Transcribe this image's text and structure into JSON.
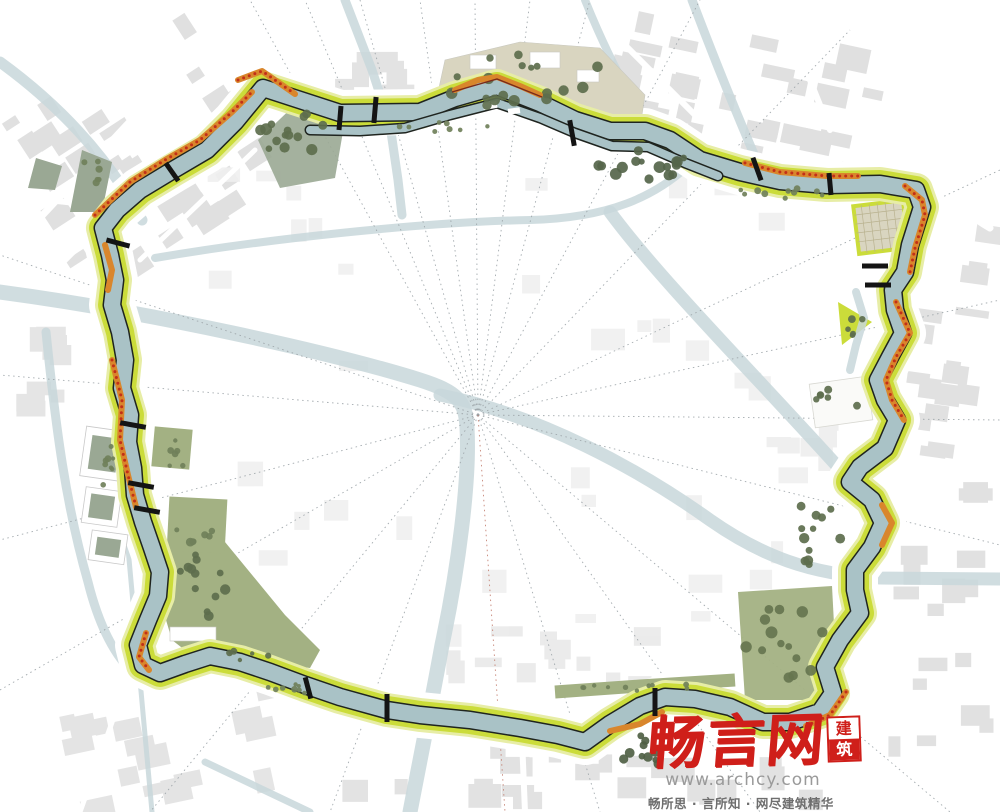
{
  "watermark": {
    "logo_text": "畅言网",
    "seal_top": "建",
    "seal_bottom": "筑",
    "url": "www.archcy.com",
    "slogan": "畅所思 · 言所知 · 网尽建筑精华"
  },
  "palette": {
    "water_ring": "#a9c2c6",
    "water_pale": "#c8d7da",
    "bank_green": "#cbdc3a",
    "bank_light": "#e7eda6",
    "quay_black": "#1f241f",
    "tree_dark": "#5d6e4d",
    "tree_mid": "#70805a",
    "park_olive": "#a3b183",
    "park_sage": "#9aa894",
    "park_beige": "#d9d5c0",
    "block_gray": "#e0e0e0",
    "block_faint": "#f0f0f0",
    "orange": "#d9862c",
    "red_dot": "#c22f18",
    "bridge_black": "#141414",
    "logo_red": "#cf1f1a"
  }
}
